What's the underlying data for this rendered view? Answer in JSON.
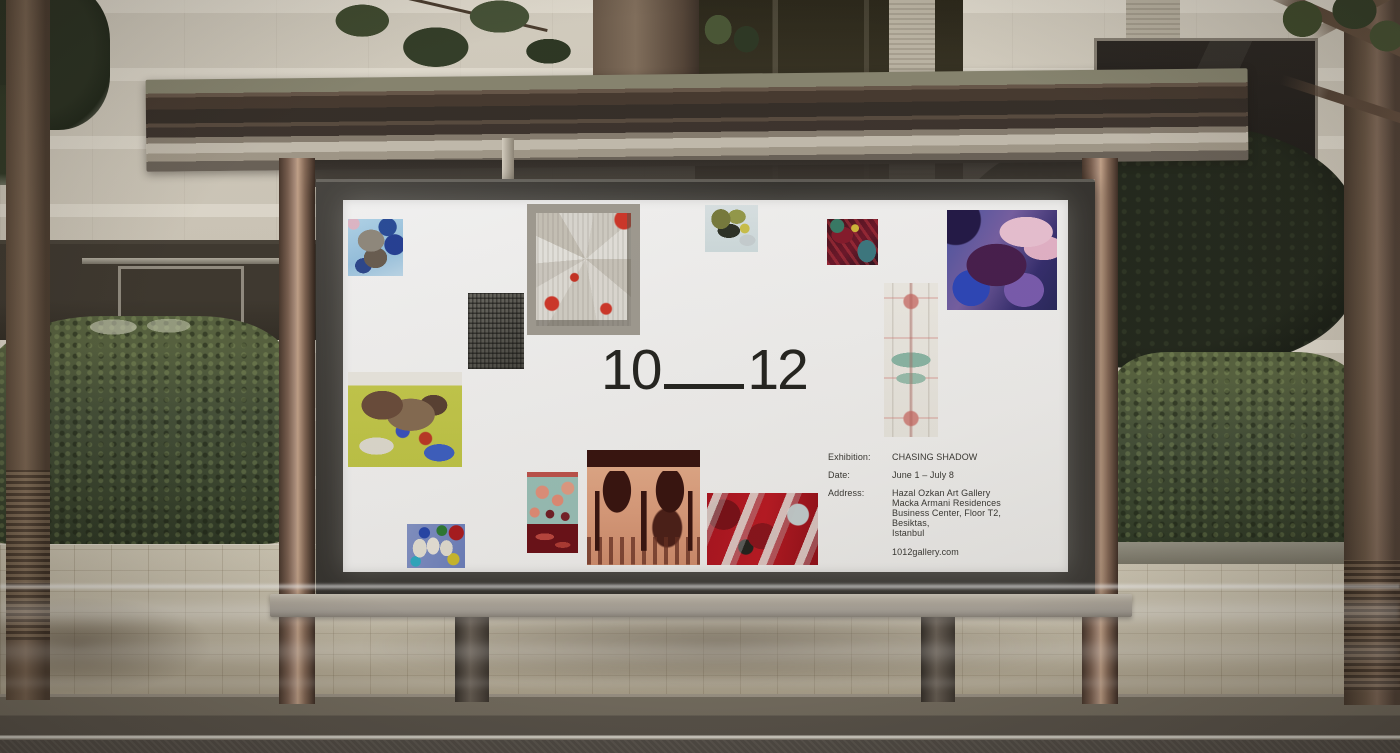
{
  "scene": {
    "setting": "night-time street bus shelter with backlit billboard poster",
    "palette": {
      "poster_bg": "#f7f6f4",
      "poster_text": "#3b3a35",
      "billboard_frame": "#3a3835",
      "shelter_roof_bronze": "#44392f",
      "support_column_copper": "#8a6d5a",
      "hedge_green": "#46523a",
      "pavement_beige": "#c6bda6",
      "artwork_accent_red": "#c0251f"
    }
  },
  "poster": {
    "logo": {
      "left": "10",
      "right": "12"
    },
    "info": {
      "exhibition_label": "Exhibition:",
      "exhibition_value": "CHASING SHADOW",
      "date_label": "Date:",
      "date_value": "June 1 – July 8",
      "address_label": "Address:",
      "address_lines": [
        "Hazal Ozkan Art Gallery",
        "Macka Armani Residences",
        "Business Center, Floor T2, Besiktas,",
        "Istanbul"
      ],
      "website": "1012gallery.com"
    },
    "artworks": [
      {
        "desc": "Abstract collage — blue figure on sky-blue ground"
      },
      {
        "desc": "Fanned grey panels with red edges in timber frame"
      },
      {
        "desc": "Olive-green paint swirls on pale blue ground"
      },
      {
        "desc": "Crimson abstract with teal corner"
      },
      {
        "desc": "Purple-and-pink collage of two figures"
      },
      {
        "desc": "Charcoal cobbled texture study"
      },
      {
        "desc": "Crumpled paint forms on chartreuse ground"
      },
      {
        "desc": "Symmetric totem pattern in cream, red and teal"
      },
      {
        "desc": "Salmon droplets over dark red field"
      },
      {
        "desc": "Ornate dark gates on peach ground"
      },
      {
        "desc": "Pale ribbons over red ground"
      },
      {
        "desc": "White figures with primary accents on blue"
      }
    ]
  }
}
